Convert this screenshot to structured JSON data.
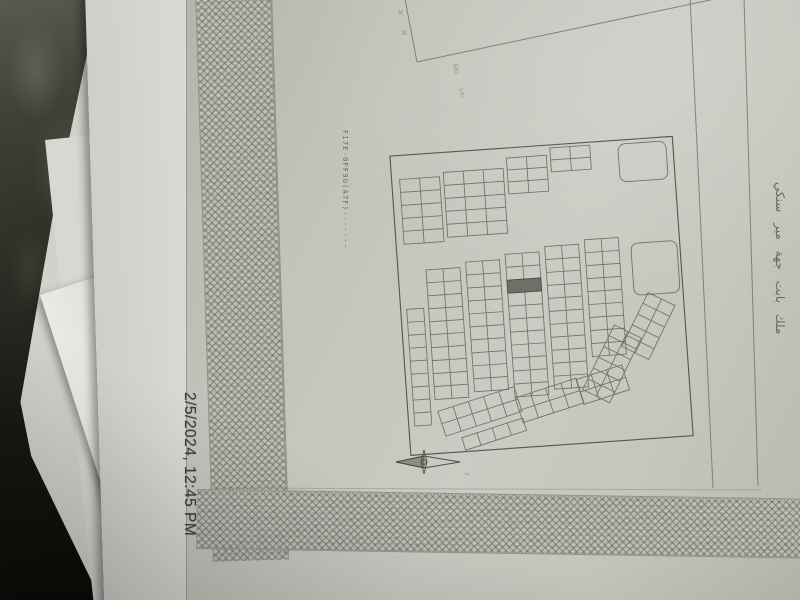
{
  "photo": {
    "timestamp": "2/5/2024, 12:45 PM"
  },
  "document": {
    "reference_number": "F17E-0FF9G(A7F)·······",
    "side_annotation": "ملك بابت جهة مير سنكي",
    "dimension_mark_1": "600",
    "dimension_mark_2": "140",
    "corner_mark": "7"
  },
  "map": {
    "icon": "compass-north-arrow",
    "highlighted_plot": true
  },
  "colors": {
    "table_surface": "#17150f",
    "paper": "#c3c3bc",
    "pencil_ink": "#5b5b53",
    "border_pattern_ink": "#60605 7",
    "highlighted_plot": "#6f6f68",
    "timestamp_text": "#3c3c38"
  }
}
